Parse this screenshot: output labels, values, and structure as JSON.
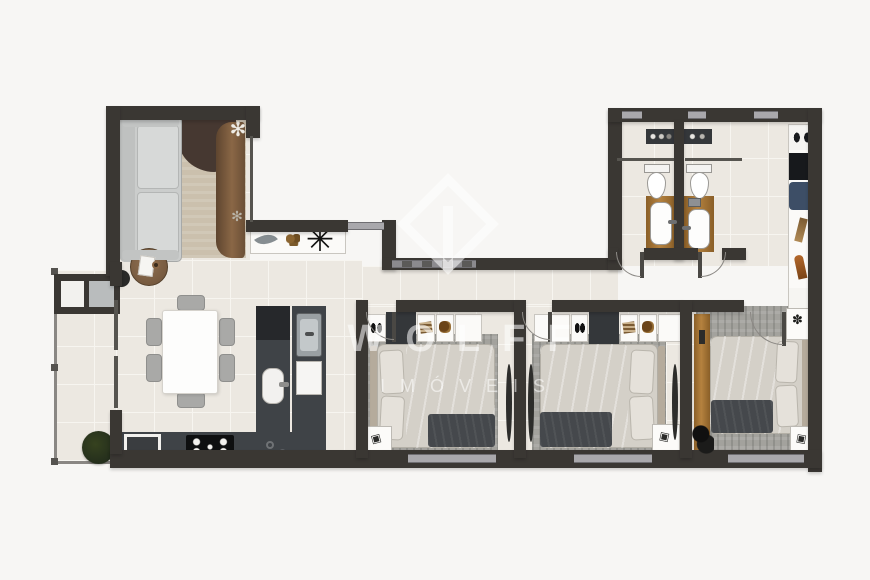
{
  "watermark": {
    "line1": "WOLFF",
    "line2": "IMÓVEIS",
    "logo": "diamond-monogram"
  },
  "palette": {
    "page": "#f7f6f4",
    "floor": "#ece8e1",
    "grout": "#f7f5f0",
    "wall": "#3a3733",
    "counter": "#3f4347",
    "wood": "#a9773b",
    "rug_bedroom": "#a3a29d",
    "rug_living": "#cbc0ad",
    "bed_linen": "#d4d0c8",
    "blanket": "#45484c",
    "sofa": "#cbcdcc",
    "plant_dark": "#242e1c",
    "appliance_black": "#17191c",
    "appliance_blue": "#3d4e66",
    "watermark": "rgba(255,255,255,0.55)"
  },
  "rooms": [
    "balcony",
    "living-room",
    "dining-room",
    "kitchen",
    "hallway",
    "bedroom-1",
    "bedroom-2",
    "master-bedroom",
    "bathroom-1",
    "bathroom-2",
    "laundry-closet"
  ],
  "fixtures": [
    "sofa",
    "living-rug",
    "curtain",
    "round-side-table",
    "console-with-plants",
    "planter-bench",
    "floor-plant",
    "dining-table",
    "six-chairs",
    "l-counter",
    "cooktop",
    "oven",
    "kitchen-sink",
    "double-bed-x3",
    "wardrobe-x3",
    "nightstands",
    "toilet-x2",
    "vanity-x2",
    "shower-glass-x2",
    "washer",
    "laundry-shelves"
  ]
}
